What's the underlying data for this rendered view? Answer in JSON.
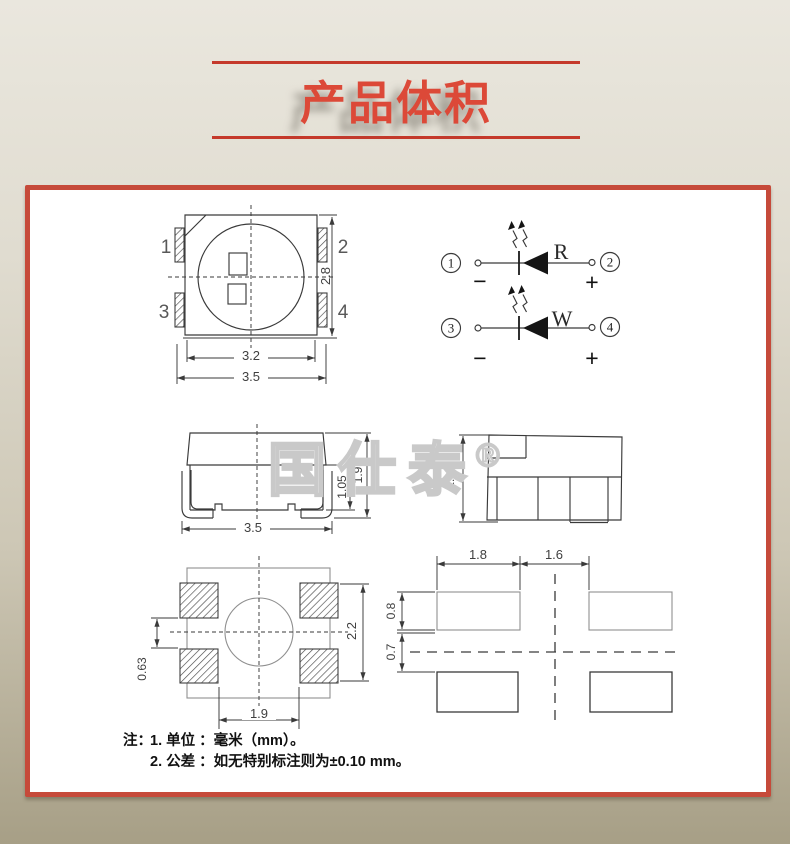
{
  "title": {
    "text": "产品体积"
  },
  "watermark": {
    "text": "国仕泰",
    "registered_mark": "®"
  },
  "top_view": {
    "pin_labels": {
      "p1": "1",
      "p2": "2",
      "p3": "3",
      "p4": "4"
    },
    "dims": {
      "body_width": "3.2",
      "overall_width": "3.5",
      "overall_height": "2.8"
    }
  },
  "circuit": {
    "red_led": {
      "left_terminal": "1",
      "right_terminal": "2",
      "color_label": "R",
      "cathode_sign": "−",
      "anode_sign": "+"
    },
    "white_led": {
      "left_terminal": "3",
      "right_terminal": "4",
      "color_label": "W",
      "cathode_sign": "−",
      "anode_sign": "+"
    }
  },
  "front_view": {
    "dims": {
      "overall_width": "3.5",
      "stand_height": "1.05",
      "overall_height": "1.9"
    }
  },
  "side_view": {
    "dims": {
      "overall_height": "1.90"
    }
  },
  "bottom_view": {
    "dims": {
      "pad_edge": "0.63",
      "overall_height": "2.2",
      "pad_span": "1.9"
    }
  },
  "pad_layout": {
    "dims": {
      "pad_width": "1.8",
      "pad_gap": "1.6",
      "pad_height": "0.8",
      "row_gap": "0.7"
    }
  },
  "notes": {
    "label": "注：",
    "line1": "1. 单位 ：毫米（mm）。",
    "line2": "2. 公差 ：如无特别标注则为±0.10 mm。"
  },
  "colors": {
    "accent_red": "#c64a3a",
    "title_red": "#dc4938",
    "paper": "#ffffff",
    "ink": "#3a3a3a"
  }
}
